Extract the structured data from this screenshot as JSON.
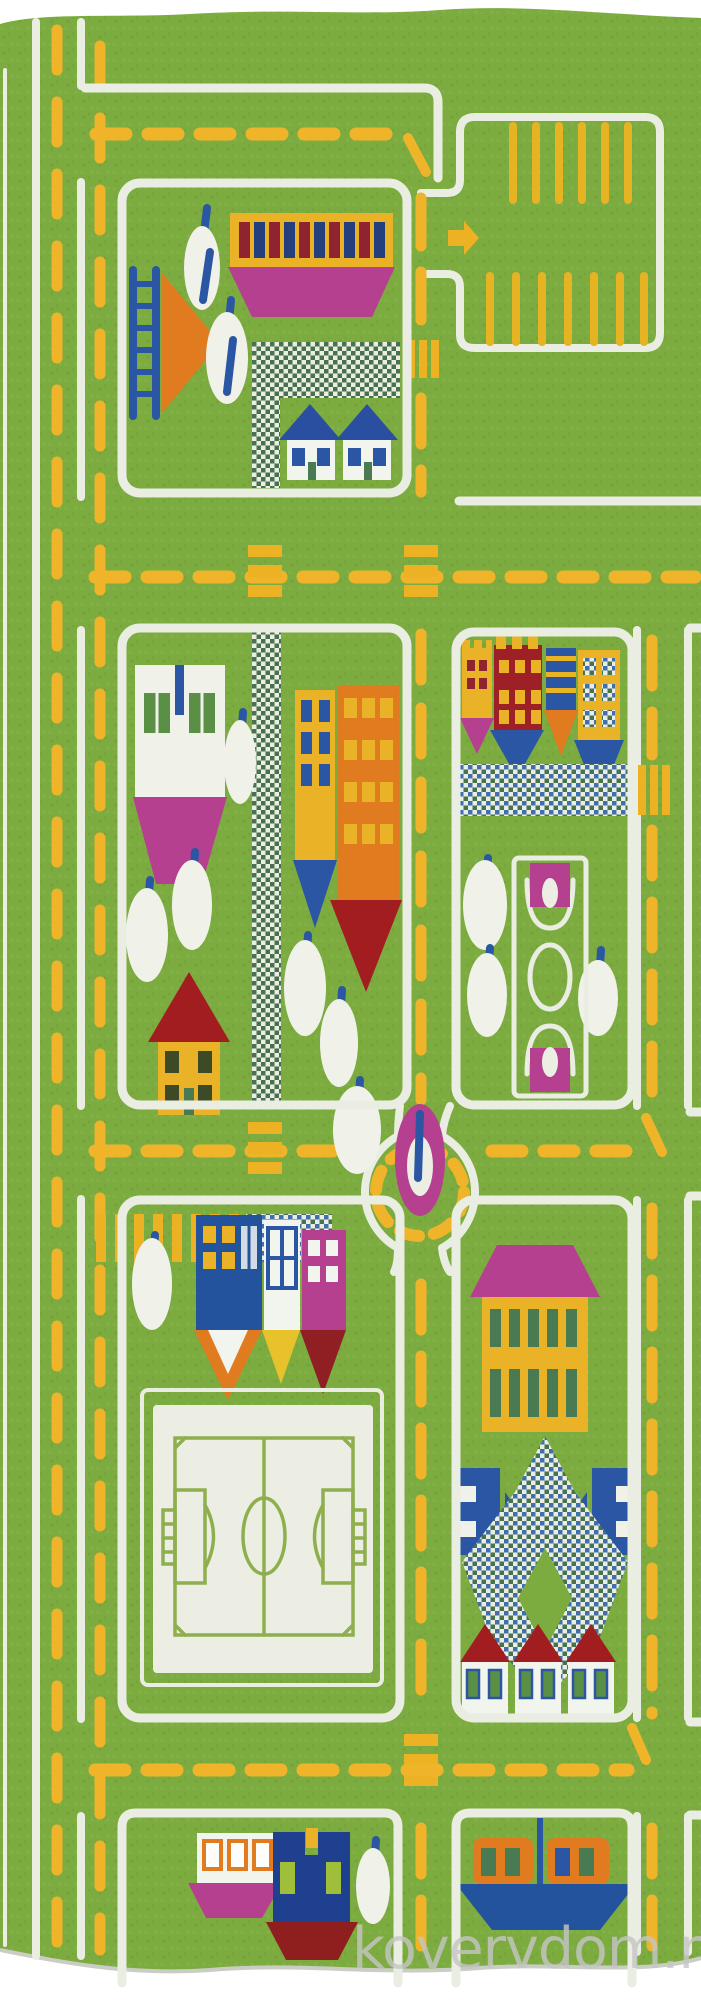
{
  "image": {
    "kind": "product-photo",
    "subject": "children's city road play rug, portrait orientation",
    "width_px": 701,
    "height_px": 2000
  },
  "watermark": {
    "text": "kovervdom.ru",
    "color": "#c6c6c6"
  },
  "palette": {
    "grass": "#7cab40",
    "road_line": "#e9ede2",
    "lane_dash": "#f0b42a",
    "magenta": "#b5408f",
    "blue": "#2b56a3",
    "navy": "#1f3f8f",
    "orange": "#e07b20",
    "red_roof": "#a21d20",
    "dark_red": "#8f1f23",
    "yellow_building": "#eab227",
    "field_line": "#8fae4e",
    "white_shape": "#f0f2ea"
  },
  "areas": [
    {
      "id": "main-road-left",
      "label": "left vertical two-lane road"
    },
    {
      "id": "parking-lot",
      "label": "parking lot with yellow space ticks and entry arrow"
    },
    {
      "id": "block-top-left",
      "label": "block with market building, ladder tree, checker path, two houses"
    },
    {
      "id": "block-middle-left",
      "label": "block with buildings, trees and red-roof house"
    },
    {
      "id": "block-middle-right",
      "label": "block with castle buildings and basketball court"
    },
    {
      "id": "roundabout",
      "label": "roundabout with magenta island tree"
    },
    {
      "id": "soccer-field",
      "label": "white soccer field"
    },
    {
      "id": "block-bottom-right",
      "label": "block with pink-roof villa, checker diamond, three houses"
    },
    {
      "id": "harbor",
      "label": "bottom harbor with boats and tug"
    }
  ]
}
